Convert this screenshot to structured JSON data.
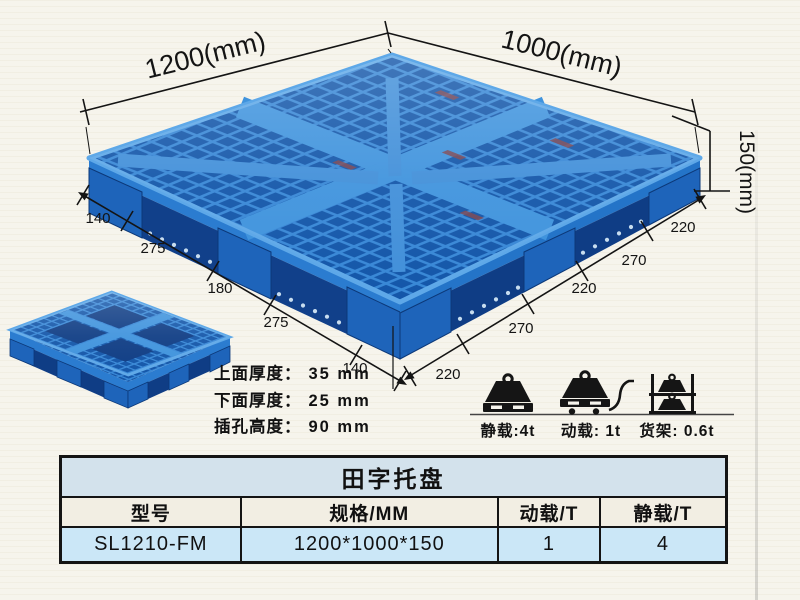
{
  "window": {
    "bg_color": "#f6f4ec"
  },
  "diagram": {
    "dim_width_label": "1200(mm)",
    "dim_depth_label": "1000(mm)",
    "dim_height_label": "150(mm)",
    "left_chain": [
      "140",
      "275",
      "180",
      "275",
      "140"
    ],
    "right_chain": [
      "220",
      "270",
      "220",
      "270",
      "220"
    ],
    "thickness_notes": [
      {
        "label": "上面厚度：",
        "value": "35 mm"
      },
      {
        "label": "下面厚度：",
        "value": "25 mm"
      },
      {
        "label": "插孔高度：",
        "value": "90 mm"
      }
    ],
    "load_ratings": [
      {
        "icon": "static-load-icon",
        "label": "静载:4t"
      },
      {
        "icon": "dynamic-load-icon",
        "label": "动载: 1t"
      },
      {
        "icon": "rack-load-icon",
        "label": "货架: 0.6t"
      }
    ],
    "colors": {
      "pallet_blue": "#2e7fd0",
      "pallet_dark_blue": "#11408a",
      "pallet_highlight": "#5ea8e8",
      "annotation": "#141414"
    }
  },
  "spec_table": {
    "title": "田字托盘",
    "headers": [
      "型号",
      "规格/MM",
      "动载/T",
      "静载/T"
    ],
    "rows": [
      {
        "model": "SL1210-FM",
        "spec": "1200*1000*150",
        "dynamic_load": "1",
        "static_load": "4"
      }
    ],
    "colors": {
      "title_bg": "#d3e2ec",
      "header_bg": "#f2eee3",
      "row_bg": "#cbe7f7",
      "border": "#141414"
    }
  }
}
